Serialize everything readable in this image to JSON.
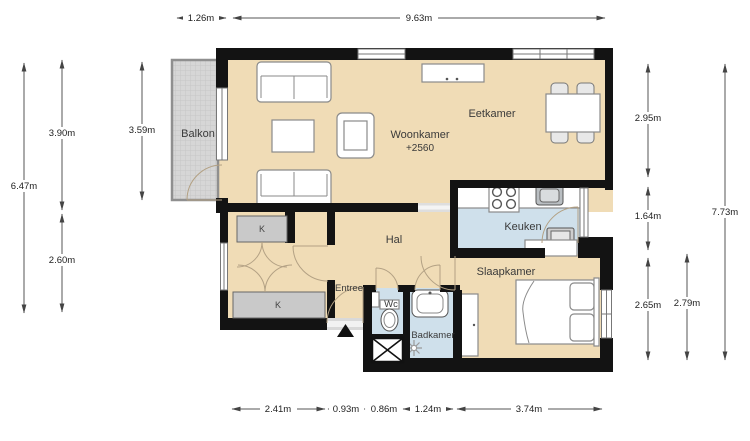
{
  "plan": {
    "title": "apartment-floor-plan",
    "rooms": {
      "balkon": {
        "label": "Balkon"
      },
      "woonkamer": {
        "label": "Woonkamer",
        "sublabel": "+2560"
      },
      "eetkamer": {
        "label": "Eetkamer"
      },
      "hal": {
        "label": "Hal"
      },
      "entree": {
        "label": "Entree"
      },
      "keuken": {
        "label": "Keuken"
      },
      "slaapkamer": {
        "label": "Slaapkamer"
      },
      "wc": {
        "label": "Wc"
      },
      "badkamer": {
        "label": "Badkamer"
      },
      "closet_top": {
        "label": "K"
      },
      "closet_bottom": {
        "label": "K"
      }
    },
    "dimensions": {
      "top": [
        {
          "label": "1.26m"
        },
        {
          "label": "9.63m"
        }
      ],
      "left": [
        {
          "label": "6.47m"
        },
        {
          "label": "3.90m"
        },
        {
          "label": "2.60m"
        },
        {
          "label": "3.59m"
        }
      ],
      "right": [
        {
          "label": "2.95m"
        },
        {
          "label": "1.64m"
        },
        {
          "label": "2.65m"
        },
        {
          "label": "2.79m"
        },
        {
          "label": "7.73m"
        }
      ],
      "bottom": [
        {
          "label": "2.41m"
        },
        {
          "label": "0.93m"
        },
        {
          "label": "0.86m"
        },
        {
          "label": "1.24m"
        },
        {
          "label": "3.74m"
        }
      ]
    },
    "colors": {
      "floor": "#f0dcb6",
      "wet_room": "#cfe0eb",
      "balcony": "#d6d6d6",
      "closet": "#c9c9c9",
      "wall": "#131313",
      "dimension": "#555555"
    }
  }
}
